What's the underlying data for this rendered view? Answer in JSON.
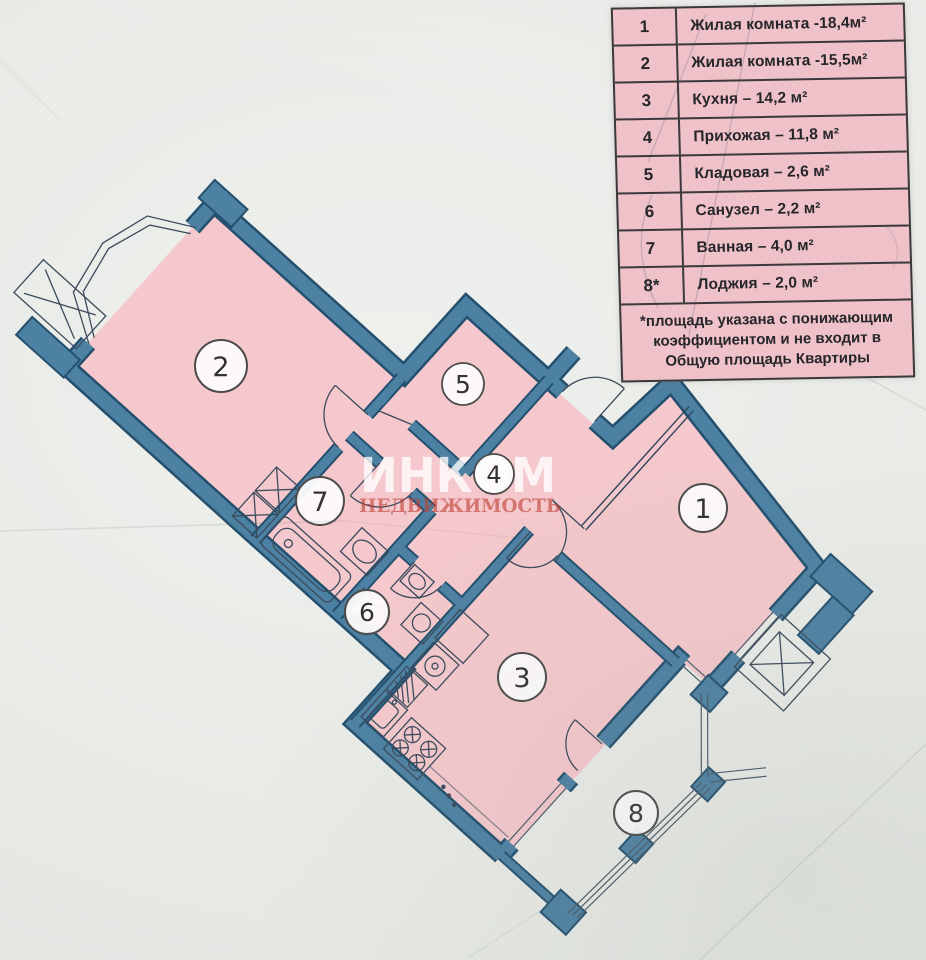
{
  "legend": {
    "rows": [
      {
        "num": "1",
        "label": "Жилая комната -18,4м²"
      },
      {
        "num": "2",
        "label": "Жилая комната -15,5м²"
      },
      {
        "num": "3",
        "label": "Кухня – 14,2 м²"
      },
      {
        "num": "4",
        "label": "Прихожая – 11,8 м²"
      },
      {
        "num": "5",
        "label": "Кладовая – 2,6 м²"
      },
      {
        "num": "6",
        "label": "Санузел – 2,2 м²"
      },
      {
        "num": "7",
        "label": "Ванная – 4,0 м²"
      },
      {
        "num": "8*",
        "label": "Лоджия – 2,0 м²"
      }
    ],
    "footnote": "*площадь указана с понижающим коэффициентом и не входит в Общую площадь Квартиры"
  },
  "watermark": {
    "line1": "ИНКОМ",
    "line2": "НЕДВИЖИМОСТЬ"
  },
  "plan": {
    "room_labels": [
      "1",
      "2",
      "3",
      "4",
      "5",
      "6",
      "7",
      "8"
    ]
  },
  "colors": {
    "paper": "#e8eae6",
    "room_fill": "#f4c8cc",
    "legend_bg": "#eec2c8",
    "wall_blue": "#4d81a3",
    "wall_edge": "#24506e",
    "watermark_red": "#be3c30",
    "text": "#26262a"
  }
}
